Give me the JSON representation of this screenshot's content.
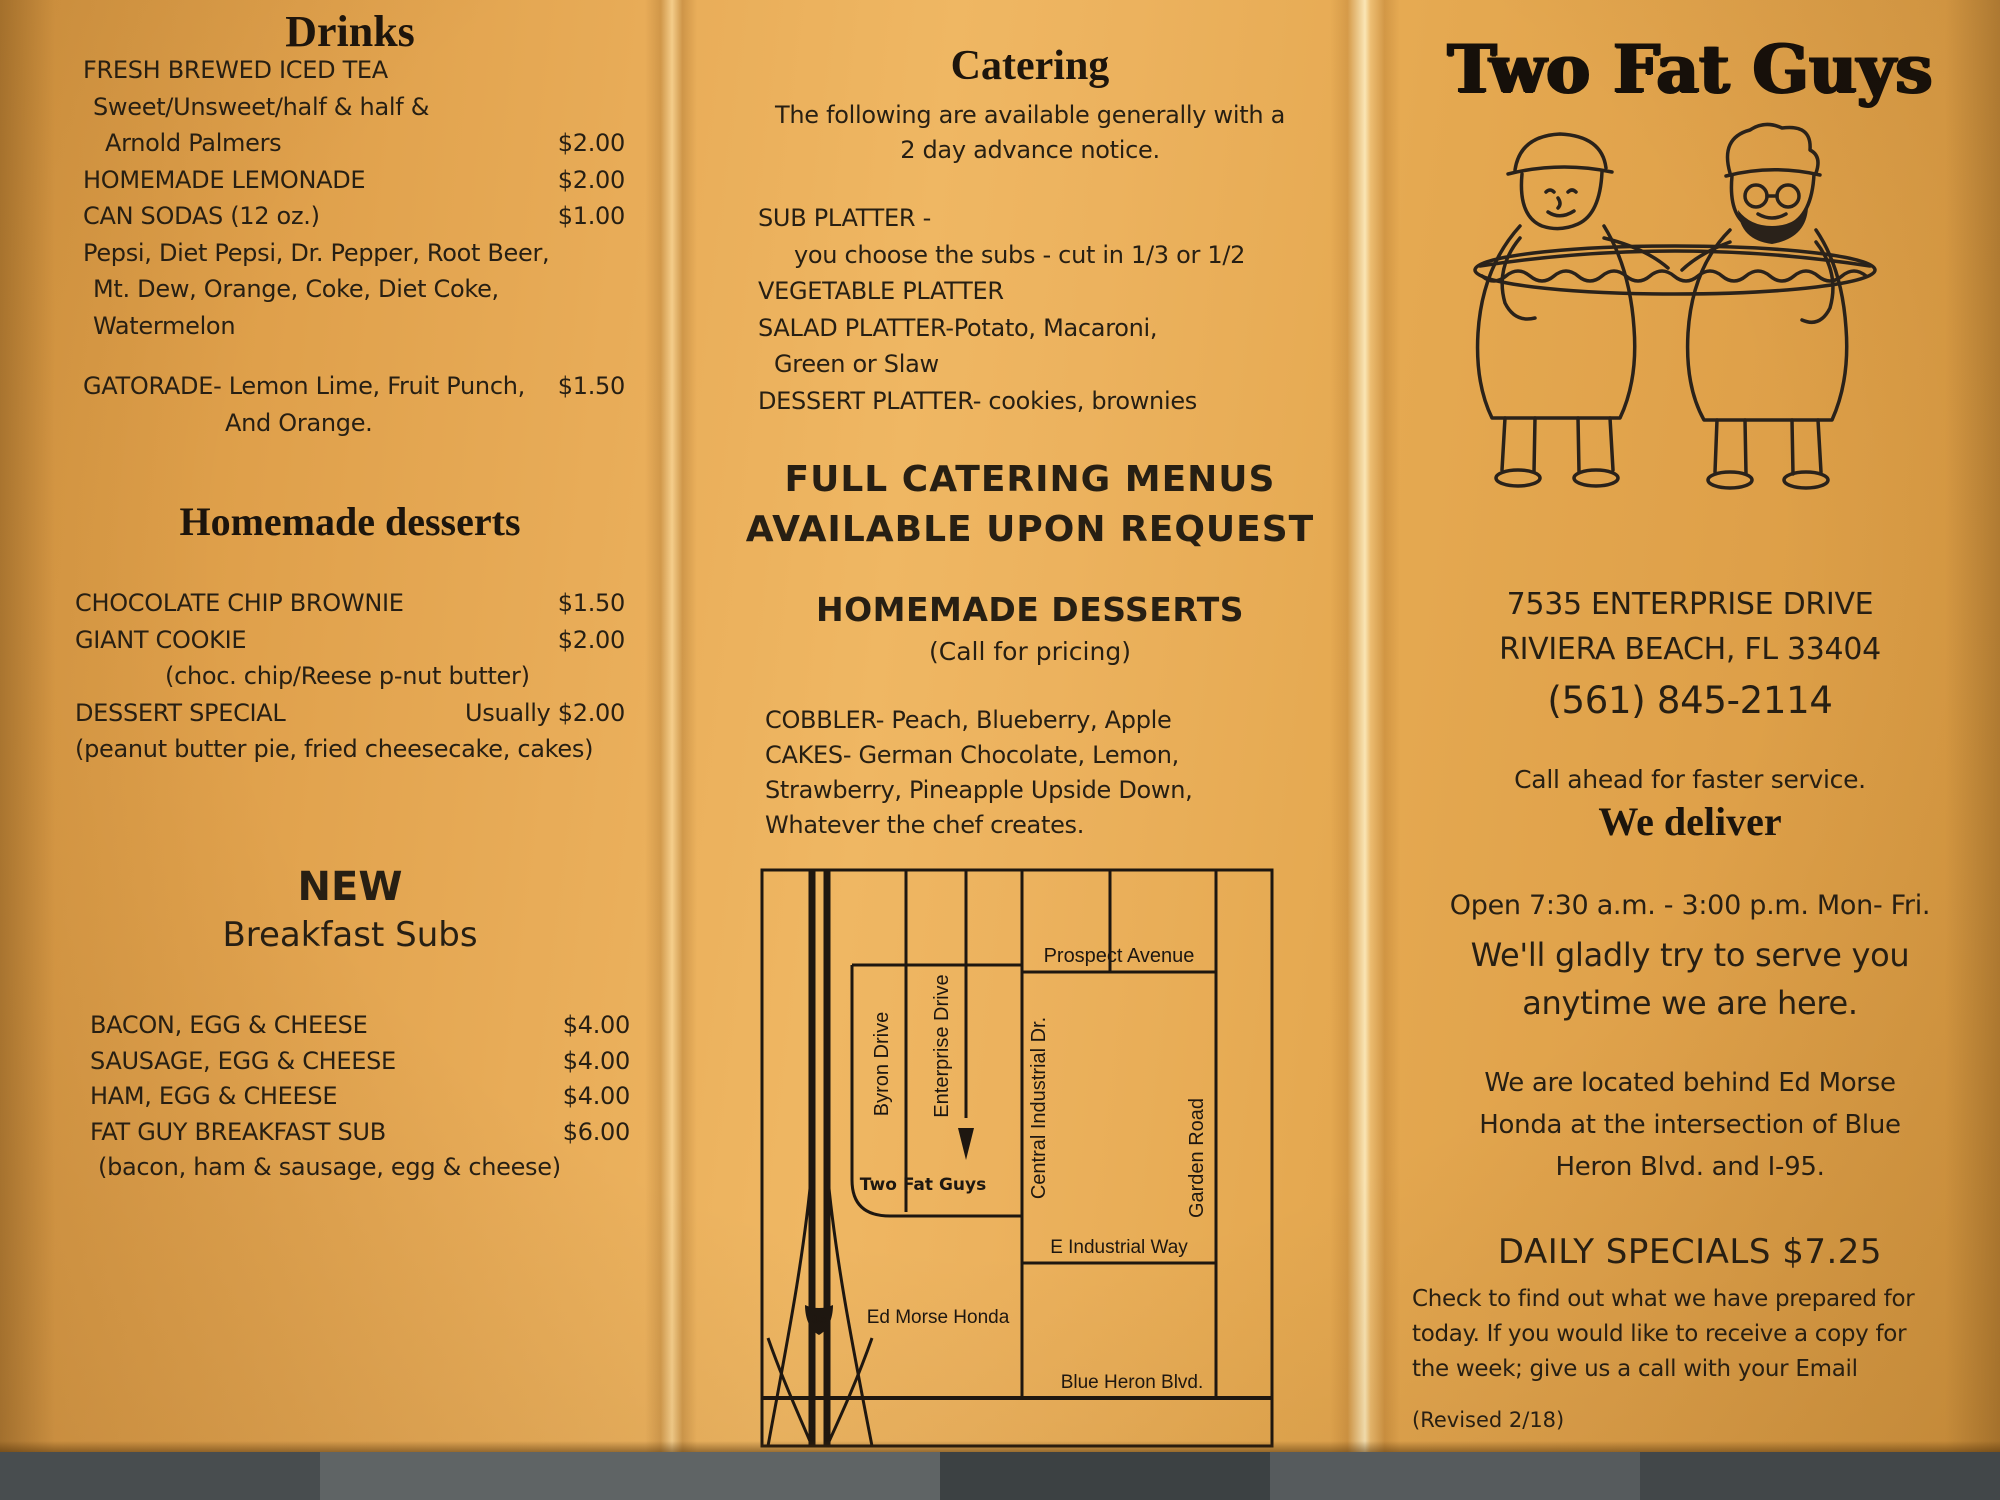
{
  "colors": {
    "paper": "#e7aa54",
    "ink": "#271f13",
    "photo_background": "#5c6162"
  },
  "left": {
    "drinks_heading": "Drinks",
    "drinks_items": [
      {
        "text": "FRESH BREWED ICED TEA",
        "price": ""
      },
      {
        "text": "Sweet/Unsweet/half & half &",
        "price": ""
      },
      {
        "text": "Arnold Palmers",
        "price": "$2.00"
      },
      {
        "text": "HOMEMADE LEMONADE",
        "price": "$2.00"
      },
      {
        "text": "CAN SODAS (12 oz.)",
        "price": "$1.00"
      },
      {
        "text": "Pepsi, Diet Pepsi, Dr. Pepper, Root Beer,",
        "price": ""
      },
      {
        "text": "Mt. Dew, Orange, Coke, Diet Coke,",
        "price": ""
      },
      {
        "text": "Watermelon",
        "price": ""
      },
      {
        "text": "GATORADE- Lemon Lime, Fruit Punch,",
        "price": "$1.50"
      },
      {
        "text": "And Orange.",
        "price": ""
      }
    ],
    "desserts_heading": "Homemade desserts",
    "desserts_items": [
      {
        "text": "CHOCOLATE CHIP BROWNIE",
        "price": "$1.50"
      },
      {
        "text": "GIANT COOKIE",
        "price": "$2.00"
      },
      {
        "text": "(choc. chip/Reese p-nut butter)",
        "price": ""
      },
      {
        "text": "DESSERT SPECIAL",
        "price": "Usually $2.00"
      },
      {
        "text": "(peanut butter pie, fried cheesecake, cakes)",
        "price": ""
      }
    ],
    "new_label": "NEW",
    "breakfast_heading": "Breakfast Subs",
    "breakfast_items": [
      {
        "text": "BACON, EGG & CHEESE",
        "price": "$4.00"
      },
      {
        "text": "SAUSAGE, EGG & CHEESE",
        "price": "$4.00"
      },
      {
        "text": "HAM, EGG & CHEESE",
        "price": "$4.00"
      },
      {
        "text": "FAT GUY BREAKFAST SUB",
        "price": "$6.00"
      },
      {
        "text": "(bacon, ham & sausage, egg & cheese)",
        "price": ""
      }
    ]
  },
  "middle": {
    "catering_heading": "Catering",
    "catering_intro": [
      "The following are available generally with a",
      "2 day advance notice."
    ],
    "platters": [
      "SUB PLATTER -",
      "you choose the subs - cut in 1/3 or 1/2",
      "VEGETABLE PLATTER",
      "SALAD PLATTER-Potato, Macaroni,",
      "Green or Slaw",
      "DESSERT PLATTER- cookies, brownies"
    ],
    "full_catering": [
      "FULL CATERING MENUS",
      "AVAILABLE UPON REQUEST"
    ],
    "hd_heading": "HOMEMADE DESSERTS",
    "hd_sub": "(Call for pricing)",
    "hd_items": [
      "COBBLER- Peach, Blueberry, Apple",
      "CAKES- German Chocolate, Lemon,",
      "Strawberry, Pineapple Upside Down,",
      "Whatever the chef creates."
    ],
    "map": {
      "byron": "Byron Drive",
      "enterprise": "Enterprise Drive",
      "central": "Central Industrial Dr.",
      "garden": "Garden Road",
      "prospect": "Prospect Avenue",
      "tfg": "Two Fat Guys",
      "e_industrial": "E Industrial Way",
      "ed_morse": "Ed Morse Honda",
      "blue_heron": "Blue Heron Blvd.",
      "i95": "95"
    }
  },
  "right": {
    "logo": "Two Fat Guys",
    "address1": "7535 ENTERPRISE DRIVE",
    "address2": "RIVIERA BEACH, FL 33404",
    "phone": "(561) 845-2114",
    "call_ahead": "Call ahead for faster service.",
    "we_deliver": "We deliver",
    "hours": "Open 7:30 a.m. - 3:00 p.m. Mon- Fri.",
    "serve1": "We'll gladly try to serve you",
    "serve2": "anytime we are here.",
    "located": [
      "We are located behind Ed Morse",
      "Honda at the intersection of Blue",
      "Heron Blvd. and I-95."
    ],
    "daily_heading": "DAILY SPECIALS $7.25",
    "daily_body": [
      "Check to find out what we have prepared for",
      "today. If you would like to receive a copy for",
      "the week; give us a call with your Email"
    ],
    "revised": "(Revised 2/18)"
  }
}
